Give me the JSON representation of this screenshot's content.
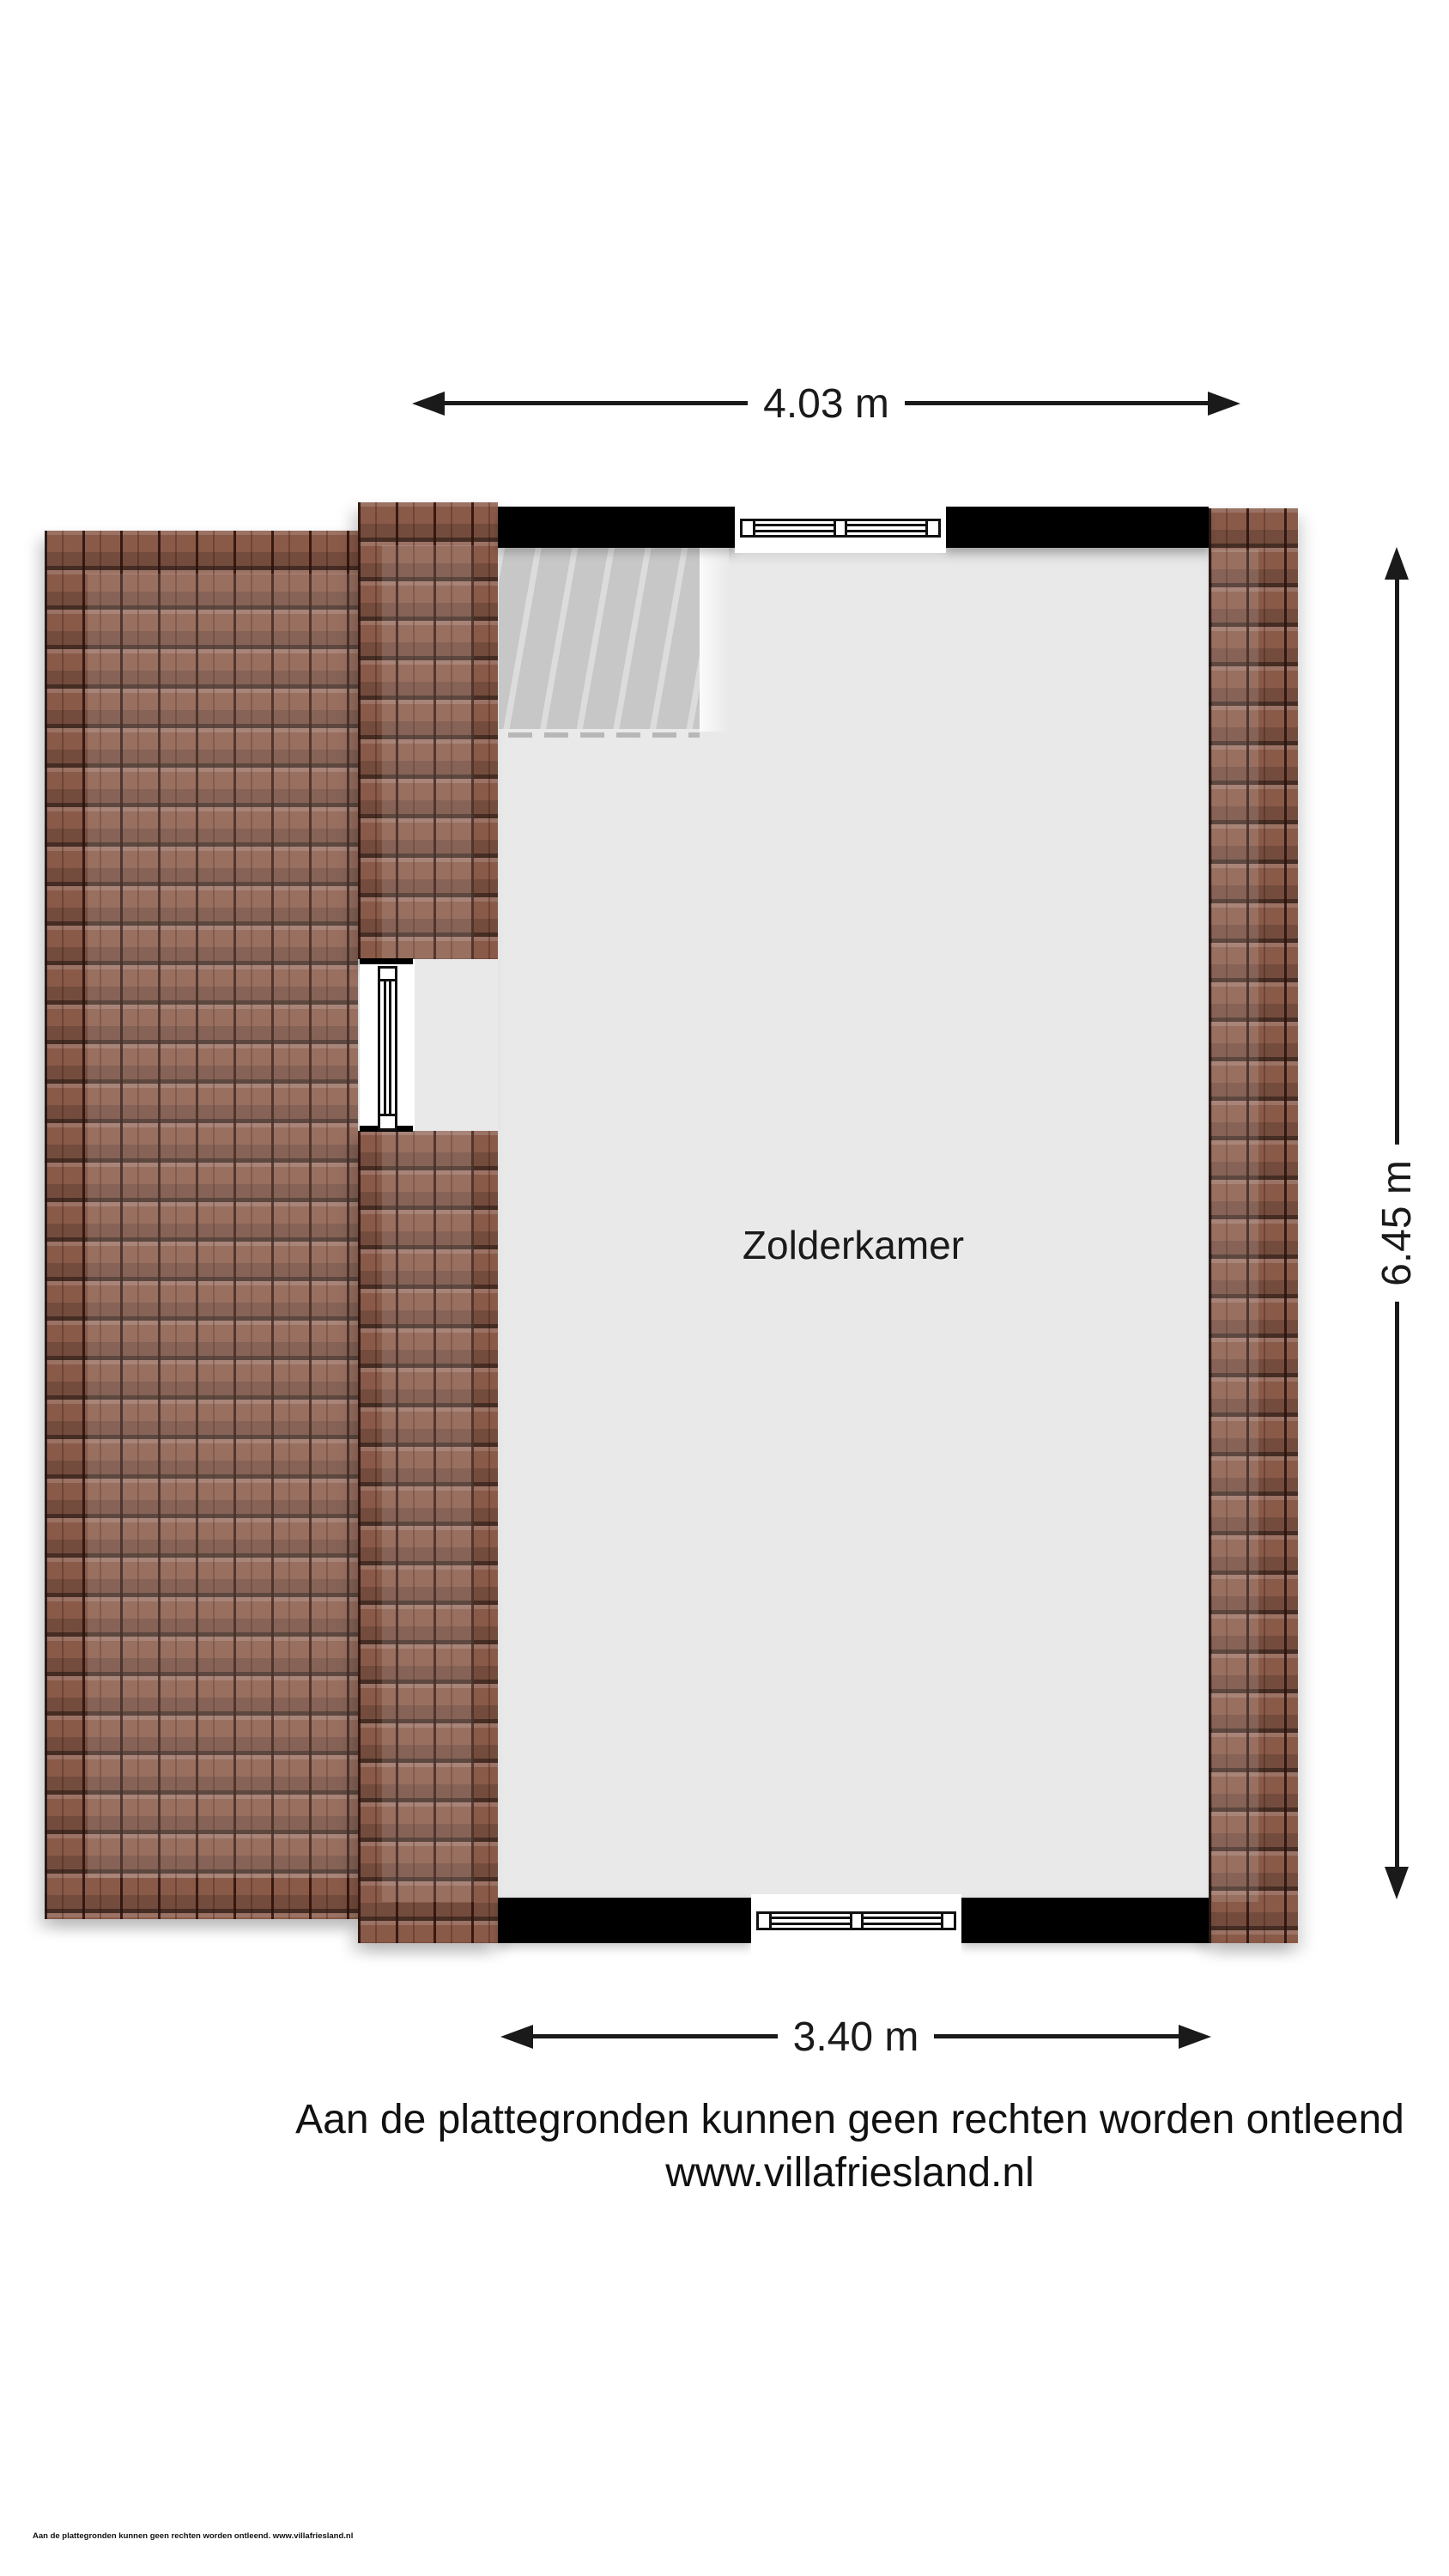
{
  "plan": {
    "room_label": "Zolderkamer",
    "dimensions": {
      "top_width": "4.03 m",
      "right_height": "6.45 m",
      "bottom_width": "3.40 m"
    }
  },
  "footer": {
    "disclaimer": "Aan de plattegronden kunnen geen rechten worden ontleend",
    "website": "www.villafriesland.nl",
    "fine_print": "Aan de plattegronden kunnen geen rechten worden ontleend. www.villafriesland.nl"
  },
  "colors": {
    "roof_tile_base": "#8a5a49",
    "roof_tile_line": "#2b100a",
    "wall": "#000000",
    "floor": "#e9e9e9",
    "stairs": "#c7c7c7",
    "dimension_line": "#1a1a1a",
    "text": "#111111",
    "background": "#ffffff"
  }
}
